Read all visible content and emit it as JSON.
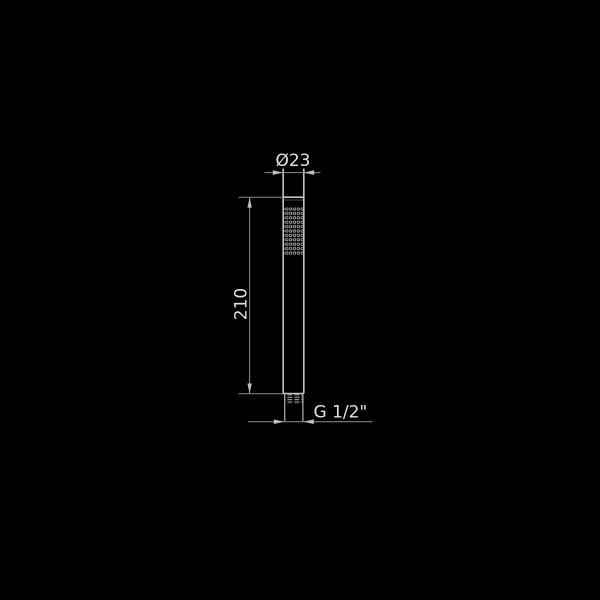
{
  "drawing": {
    "description": "black-background technical line drawing of a cylindrical handheld shower wand, side elevation with dimensions",
    "labels": {
      "diameter": "Ø23",
      "height": "210",
      "thread": "G 1/2\""
    },
    "colors": {
      "background": "#000000",
      "dimension_line": "#8f8f8f",
      "object_outline": "#c2c2c2",
      "text": "#e2e2e2"
    }
  }
}
